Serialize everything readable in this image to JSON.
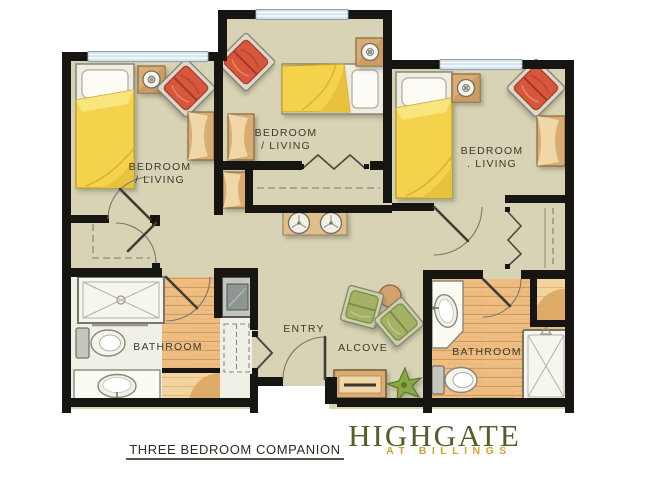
{
  "plan": {
    "rooms": [
      {
        "id": "bedroom-left",
        "line1": "BEDROOM",
        "line2": "/ LIVING"
      },
      {
        "id": "bedroom-center",
        "line1": "BEDROOM",
        "line2": "/ LIVING"
      },
      {
        "id": "bedroom-right",
        "line1": "BEDROOM",
        "line2": ". LIVING"
      },
      {
        "id": "bathroom-left",
        "line1": "BATHROOM"
      },
      {
        "id": "entry",
        "line1": "ENTRY"
      },
      {
        "id": "alcove",
        "line1": "ALCOVE"
      },
      {
        "id": "bathroom-right",
        "line1": "BATHROOM"
      }
    ]
  },
  "footer": {
    "plan_title": "THREE BEDROOM COMPANION",
    "brand_name": "HIGHGATE",
    "brand_tagline": "AT BILLINGS"
  },
  "colors": {
    "wall": "#171512",
    "carpet_floor": "#d7d3b4",
    "wood_floor": "#eebd82",
    "wood_floor_light": "#f4d49e",
    "window_glass": "#d5e4ee",
    "bed_blanket_yellow": "#f5d24b",
    "armchair_red": "#d8573a",
    "armchair_green": "#a3b265",
    "furniture_tan": "#d9ac72",
    "fixture_white": "#f7f6ee",
    "logo_green": "#51602a",
    "logo_gold": "#d3a42c"
  }
}
